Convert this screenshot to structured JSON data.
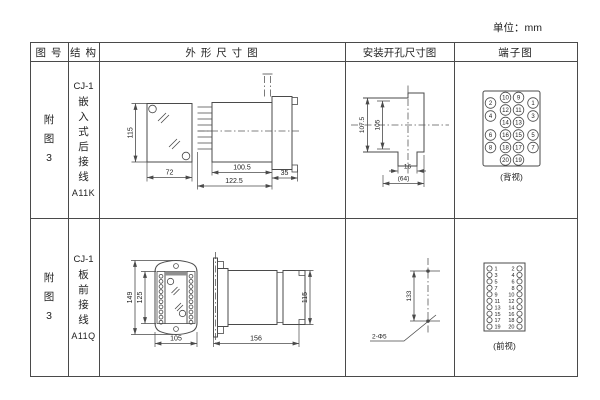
{
  "unit_label": "单位：mm",
  "headers": {
    "fig_no": "图 号",
    "structure": "结 构",
    "outline": "外 形 尺 寸 图",
    "cutout": "安装开孔尺寸图",
    "terminal": "端子图"
  },
  "rows": [
    {
      "fig_no": "附图3",
      "structure": {
        "model": "CJ-1",
        "mounting": "嵌入式后接线",
        "code": "A11K"
      },
      "outline": {
        "front_height": "115",
        "front_width": "72",
        "side_body_depth": "100.5",
        "side_total_depth": "122.5",
        "side_flange": "35"
      },
      "cutout": {
        "outer_height": "107.5",
        "inner_height": "105",
        "notch_width": "16",
        "opening_width": "(64)"
      },
      "terminal": {
        "caption": "(背视)",
        "inner_left": [
          "10",
          "12",
          "14",
          "16",
          "18",
          "20"
        ],
        "inner_right": [
          "9",
          "11",
          "13",
          "15",
          "17",
          "19"
        ],
        "outer_left": [
          "2",
          "4",
          "6",
          "8"
        ],
        "outer_right": [
          "1",
          "3",
          "5",
          "7"
        ]
      }
    },
    {
      "fig_no": "附图3",
      "structure": {
        "model": "CJ-1",
        "mounting": "板前接线",
        "code": "A11Q"
      },
      "outline": {
        "front_outer_height": "149",
        "front_inner_height": "125",
        "front_width": "105",
        "side_depth": "156",
        "side_height": "115"
      },
      "cutout": {
        "hole_spacing": "133",
        "hole_label": "2-Φ5"
      },
      "terminal": {
        "caption": "(前视)",
        "left": [
          "1",
          "3",
          "5",
          "7",
          "9",
          "11",
          "13",
          "15",
          "17",
          "19"
        ],
        "right": [
          "2",
          "4",
          "6",
          "8",
          "10",
          "12",
          "14",
          "16",
          "18",
          "20"
        ]
      }
    }
  ]
}
